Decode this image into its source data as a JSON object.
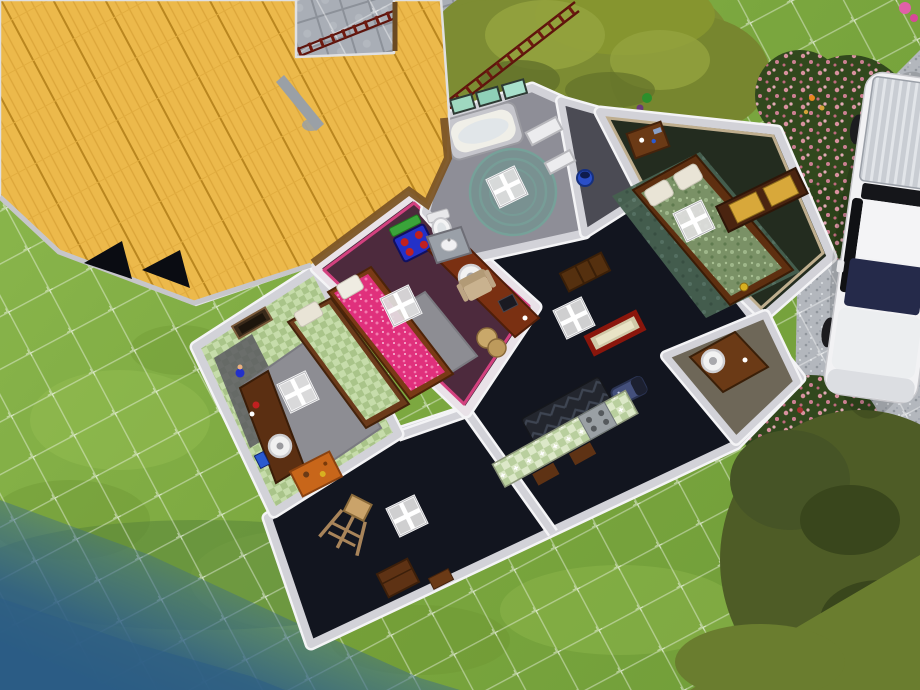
{
  "app": {
    "title": "life-sim top-down lot view",
    "mode": "live-floorplan-view"
  },
  "palette": {
    "grass": "#7fae41",
    "grass_light": "#9cc455",
    "grass_dark": "#699330",
    "water": "#35678e",
    "water_deep": "#2b5c85",
    "marsh": "#55813a",
    "stone": "#a9aeb6",
    "stone_joint": "#8c9199",
    "gravel": "#b3b7bd",
    "grid_line": "rgba(255,255,255,0.40)",
    "roof": "#ecb94b",
    "roof_plank": "#d9a337",
    "fascia": "#7c5526",
    "chimney": "#9aa0a6",
    "wall": "#d2d2d8",
    "wall_highlight": "#f4f4f6",
    "floor_dark": "#12151f",
    "floor_bath": "#8e8e97",
    "floor_closet": "#4b4b54",
    "floor_master": "#232c1f",
    "floor_office": "#6e6758",
    "floor_pink_room": "#4d2a3d",
    "trim_pink": "#d3417f",
    "trim_tan": "#bfae8e",
    "rug_gray": "#8d8d93",
    "rug_teal": "#46604f",
    "counter_green": "#b9cf9e",
    "bed_pink": "#e0307c",
    "bed_green": "#a9c489",
    "bed_master": "#7a9166",
    "pillow": "#e9e4d6",
    "wood_dark": "#5e3214",
    "wood_red": "#7a3012",
    "wood_orange": "#c8661a",
    "drawer_gold": "#d8a83a",
    "shower_teal": "#63948c",
    "window_glass": "#9fd8c0",
    "toy_blue": "#2331c8",
    "toy_red": "#c02020",
    "toy_green": "#3aa43a",
    "shelf_purple": "#5f2380",
    "sofa_dark": "#23262e",
    "armchair": "#c9b28f",
    "mirror_red": "#8a160c",
    "bassinet_blue": "#44507c",
    "fence": "#6e1a10",
    "car_body": "#f2f2f4",
    "car_windshield": "#252a4a",
    "car_window": "#101114",
    "bush": "#31481d",
    "flower_pink": "#d8919f",
    "flower_yellow": "#d4a23a",
    "canopy": "#4e5c26",
    "canopy_light": "#6a7d2f",
    "tree_olive": "#7d8c33",
    "lily": "#76a437"
  },
  "lot": {
    "rooms": [
      {
        "name": "living-dining",
        "floor": "#12151f"
      },
      {
        "name": "kids-bedroom-green",
        "floor": "#a9c489"
      },
      {
        "name": "kids-bedroom-pink",
        "floor": "#4d2a3d"
      },
      {
        "name": "bathroom",
        "floor": "#8e8e97"
      },
      {
        "name": "closet",
        "floor": "#4b4b54"
      },
      {
        "name": "master-bedroom",
        "floor": "#232c1f"
      },
      {
        "name": "study-nook",
        "floor": "#6e6758"
      }
    ],
    "furniture": [
      "single-bed-green",
      "single-bed-pink",
      "double-bed-master",
      "desk-green-room",
      "desk-pink-room",
      "desk-study",
      "office-chair",
      "activity-table",
      "wall-shelves",
      "dresser-orange",
      "dresser-gold",
      "nightstand",
      "bathtub",
      "round-shower",
      "toilet",
      "sink-counter",
      "kitchen-counters",
      "stove-top",
      "dark-sofa",
      "armchair",
      "bookcase",
      "red-mirror",
      "bassinet",
      "easel",
      "crate",
      "picture-frame"
    ],
    "environment": [
      "thatched-roof",
      "chimney",
      "roof-vents",
      "stone-path",
      "gravel-driveway",
      "red-fence",
      "tree-canopy",
      "flower-bushes",
      "pond",
      "lily-pad",
      "white-car",
      "build-grid"
    ]
  },
  "counts": {
    "ceiling_light_markers": 6,
    "roof_vents": 2,
    "bathroom_windows": 3
  }
}
